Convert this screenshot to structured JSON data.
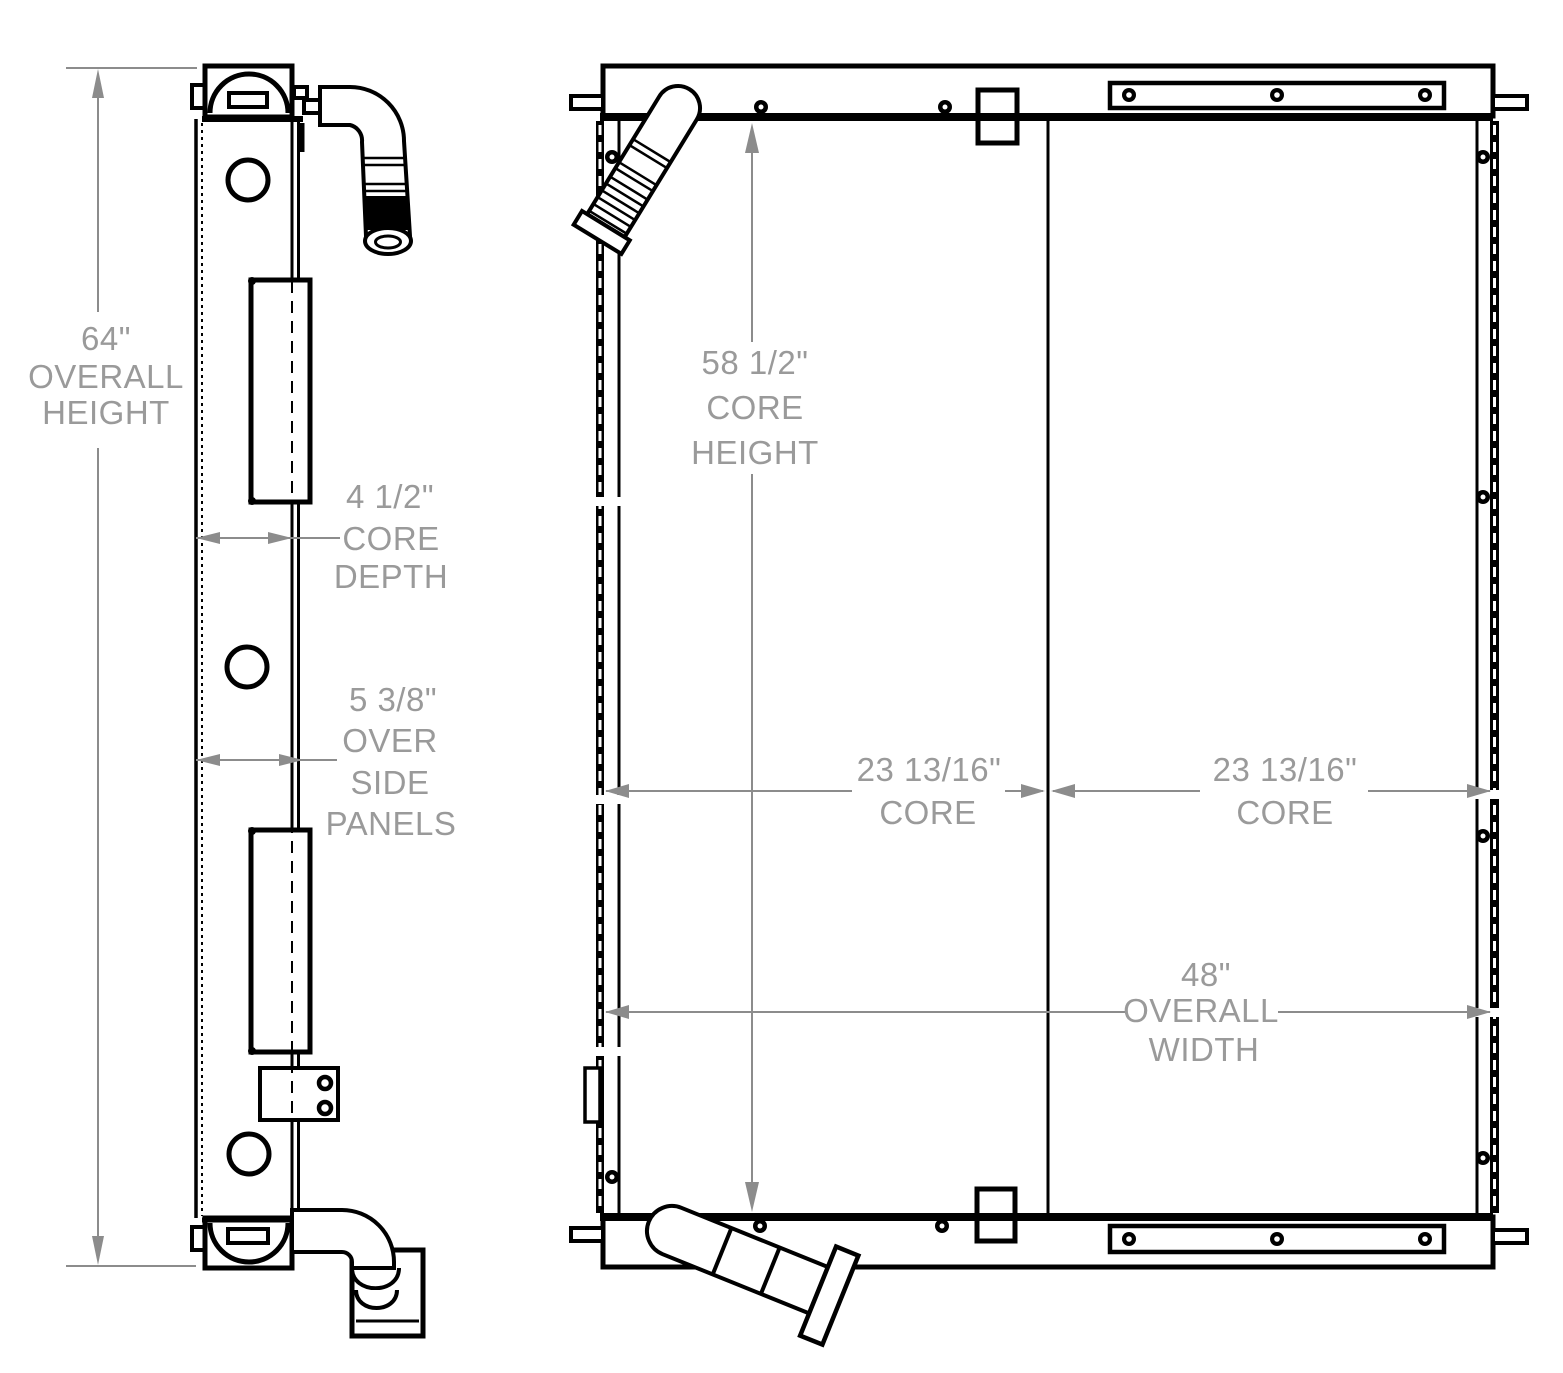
{
  "page": {
    "background": "#ffffff"
  },
  "drawing": {
    "colors": {
      "line": "#000000",
      "dimension_line": "#8c8c8c",
      "dimension_text": "#9a9a9a"
    },
    "dimensions": {
      "overall_height": {
        "lines": [
          "64\"",
          "OVERALL",
          "HEIGHT"
        ]
      },
      "core_depth": {
        "lines": [
          "4 1/2\"",
          "CORE",
          "DEPTH"
        ]
      },
      "over_side_panels": {
        "lines": [
          "5 3/8\"",
          "OVER",
          "SIDE",
          "PANELS"
        ]
      },
      "core_height": {
        "lines": [
          "58 1/2\"",
          "CORE",
          "HEIGHT"
        ]
      },
      "core_width_left": {
        "lines": [
          "23 13/16\"",
          "CORE"
        ]
      },
      "core_width_right": {
        "lines": [
          "23 13/16\"",
          "CORE"
        ]
      },
      "overall_width": {
        "lines": [
          "48\"",
          "OVERALL",
          "WIDTH"
        ]
      }
    }
  }
}
